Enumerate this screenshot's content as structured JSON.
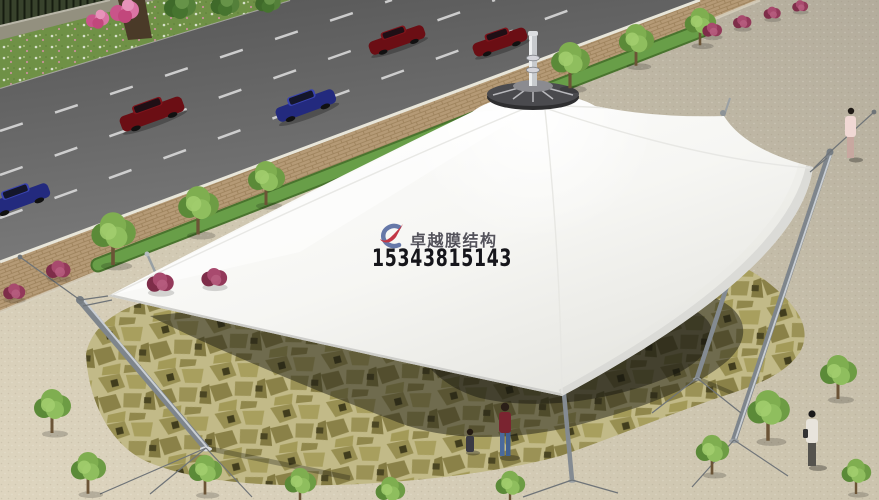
{
  "watermark": {
    "brand_text": "卓越膜结构",
    "phone_number": "15343815143",
    "brand_color": "#54535b",
    "phone_color": "#16161b",
    "logo": {
      "name": "brand-logo",
      "swoosh_color": "#6678a8",
      "ribbon_color": "#c23745"
    }
  },
  "scene": {
    "type": "aerial architectural rendering",
    "main_subject": "white tensile membrane canopy with central cone peak and steel masts",
    "ground": "olive flagstone plaza ringed by beige paving",
    "road": {
      "lanes_visible": 4,
      "lane_marking_color": "#e0e0e0",
      "asphalt_color": "#6b6b6b"
    },
    "car_colors": [
      "#6b0e14",
      "#232a7e",
      "#6b0e14",
      "#6b0e14",
      "#232a7e"
    ],
    "membrane_color": "#f7f7f5",
    "mast_color": "#9098a0",
    "flagstone_color": "#9a9257",
    "people_count": 4,
    "vegetation": {
      "tree_color": "#6d9c44",
      "shrub_color": "#93395a",
      "grass_strip_color": "#5d9140"
    }
  }
}
